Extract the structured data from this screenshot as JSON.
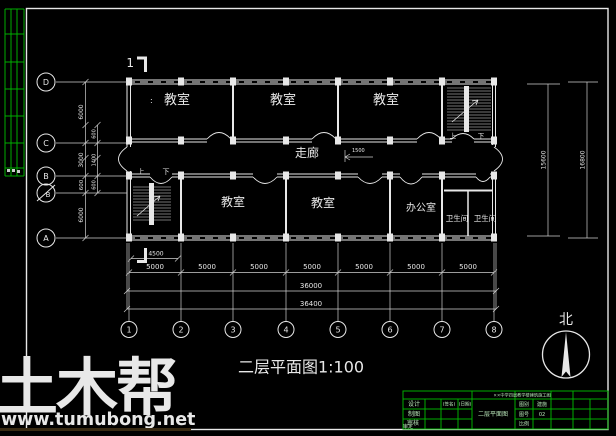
{
  "labels": {
    "classroom": "教室",
    "corridor": "走廊",
    "office": "办公室",
    "toilet": "卫生间",
    "up": "上",
    "down": "下",
    "colon": ":"
  },
  "dims": {
    "bay": "5000",
    "total": "36000",
    "overall": "36400",
    "entry": "4500",
    "corridor_note": "1500",
    "left_chain": [
      "6000",
      "3000",
      "600",
      "6000"
    ],
    "left_inner": [
      "600",
      "1400",
      "600"
    ],
    "right_inner": "15600",
    "right_outer": "16800"
  },
  "grid": {
    "cols": [
      "1",
      "2",
      "3",
      "4",
      "5",
      "6",
      "7",
      "8"
    ],
    "rows": {
      "d": "D",
      "c": "C",
      "b": "B",
      "b1": "B",
      "a": "A"
    }
  },
  "section": {
    "mark": "1"
  },
  "drawing_title": "二层平面图1:100",
  "north": {
    "label": "北"
  },
  "titleblock": {
    "project": "××中学四层教学楼建筑施工图",
    "design": "设计",
    "draft": "制图",
    "review": "审核",
    "approve": "审定",
    "sign": "(签名)",
    "date": "(日期)",
    "drawing_name": "二层平面图",
    "field_type": "图别",
    "value_type": "建施",
    "field_no": "图号",
    "value_no": "02",
    "field_scale": "比例",
    "value_scale": ""
  },
  "watermark": {
    "brand": "土木帮",
    "url": "www.tumubong.net"
  }
}
